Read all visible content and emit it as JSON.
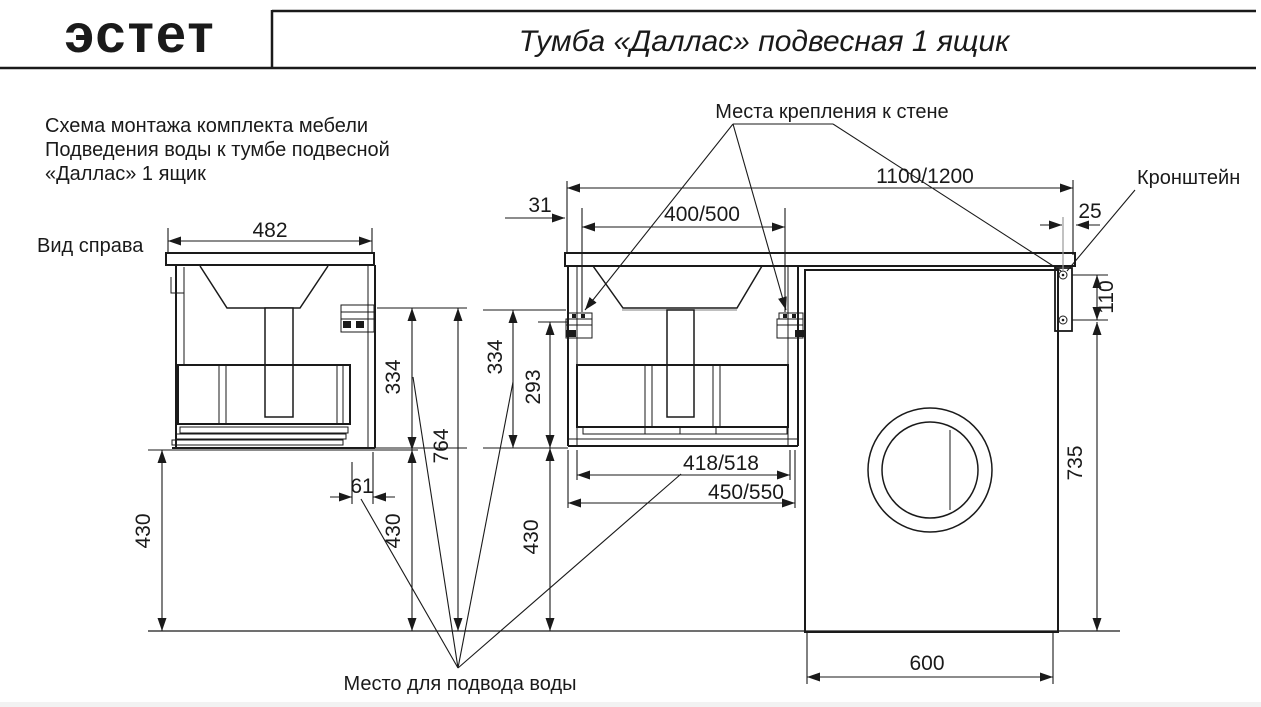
{
  "header": {
    "logo": "эстет",
    "title": "Тумба «Даллас» подвесная 1 ящик"
  },
  "notes": {
    "line1": "Схема монтажа комплекта мебели",
    "line2": "Подведения воды к тумбе подвесной",
    "line3": "«Даллас» 1 ящик",
    "side_view": "Вид справа"
  },
  "callouts": {
    "wall_mounts": "Места крепления к стене",
    "bracket": "Кронштейн",
    "water_supply": "Место для подвода воды"
  },
  "dims": {
    "side_width": "482",
    "edge_offset_31": "31",
    "mount_spacing": "400/500",
    "total_width": "1100/1200",
    "bracket_edge_25": "25",
    "bracket_holes_110": "110",
    "height_334": "334",
    "inner_height_293": "293",
    "total_height_764": "764",
    "back_offset_61": "61",
    "floor_clearance_430": "430",
    "drawer_width": "418/518",
    "cabinet_width": "450/550",
    "machine_height_735": "735",
    "machine_width_600": "600"
  }
}
